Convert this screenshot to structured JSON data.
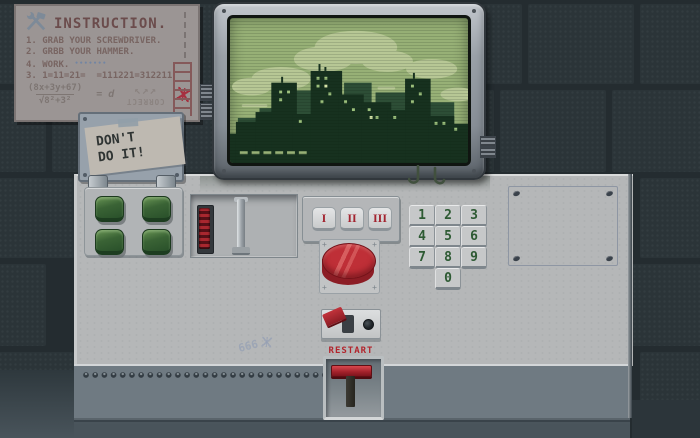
{
  "poster": {
    "title": "INSTRUCTION.",
    "items": [
      "1. GRAB YOUR SCREWDRIVER.",
      "2. GRBB YOUR HAMMER.",
      "4. WORK.",
      "3. 1=11=21=  =111221=312211"
    ],
    "work_dots": "•••••••",
    "formula": {
      "numerator": "(8x+3y+67)",
      "denominator": "√8²+3²",
      "result": "= d"
    },
    "arrows": "↖↗↗",
    "correct_label": "CORRECT"
  },
  "warning_note": {
    "line1": "DON'T",
    "line2": "DO IT!"
  },
  "console": {
    "roman_buttons": [
      "I",
      "II",
      "III"
    ],
    "keypad_keys": [
      "1",
      "2",
      "3",
      "4",
      "5",
      "6",
      "7",
      "8",
      "9",
      "0"
    ],
    "restart_label": "RESTART",
    "graffiti": "666"
  },
  "colors": {
    "wall_dark": "#242c30",
    "screen_green": "#97b076",
    "screen_silhouette": "#17311f",
    "accent_red": "#b3262e",
    "keypad_digit_green": "#2d5a33",
    "desk_gray": "#b5b7b8"
  }
}
